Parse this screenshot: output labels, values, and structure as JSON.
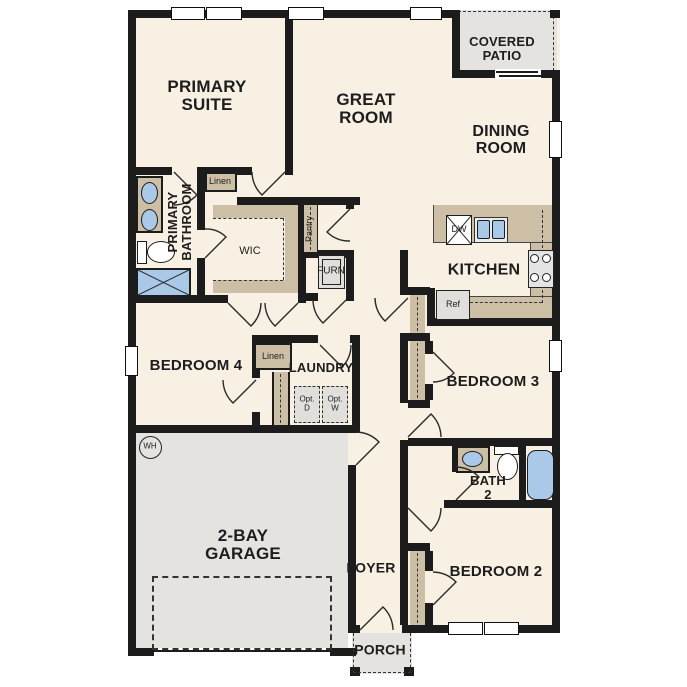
{
  "labels": {
    "primary_suite": "PRIMARY\nSUITE",
    "great_room": "GREAT\nROOM",
    "covered_patio": "COVERED\nPATIO",
    "dining_room": "DINING\nROOM",
    "primary_bathroom": "PRIMARY\nBATHROOM",
    "linen_primary": "Linen",
    "wic": "WIC",
    "pantry": "Pantry",
    "furn": "FURN",
    "kitchen": "KITCHEN",
    "dishwasher": "DW",
    "refrigerator": "Ref",
    "bedroom4": "BEDROOM 4",
    "linen_hall": "Linen",
    "laundry": "LAUNDRY",
    "opt_dryer": "Opt.\nD",
    "opt_washer": "Opt.\nW",
    "bedroom3": "BEDROOM 3",
    "bath2": "BATH\n2",
    "water_heater": "WH",
    "garage": "2-BAY\nGARAGE",
    "foyer": "FOYER",
    "bedroom2": "BEDROOM 2",
    "porch": "PORCH"
  },
  "colors": {
    "floor": "#f8f0e3",
    "outdoor": "#e4e3e0",
    "casework": "#cdbfa5",
    "plumbing": "#aac9e8",
    "wall": "#1c1c1c"
  }
}
